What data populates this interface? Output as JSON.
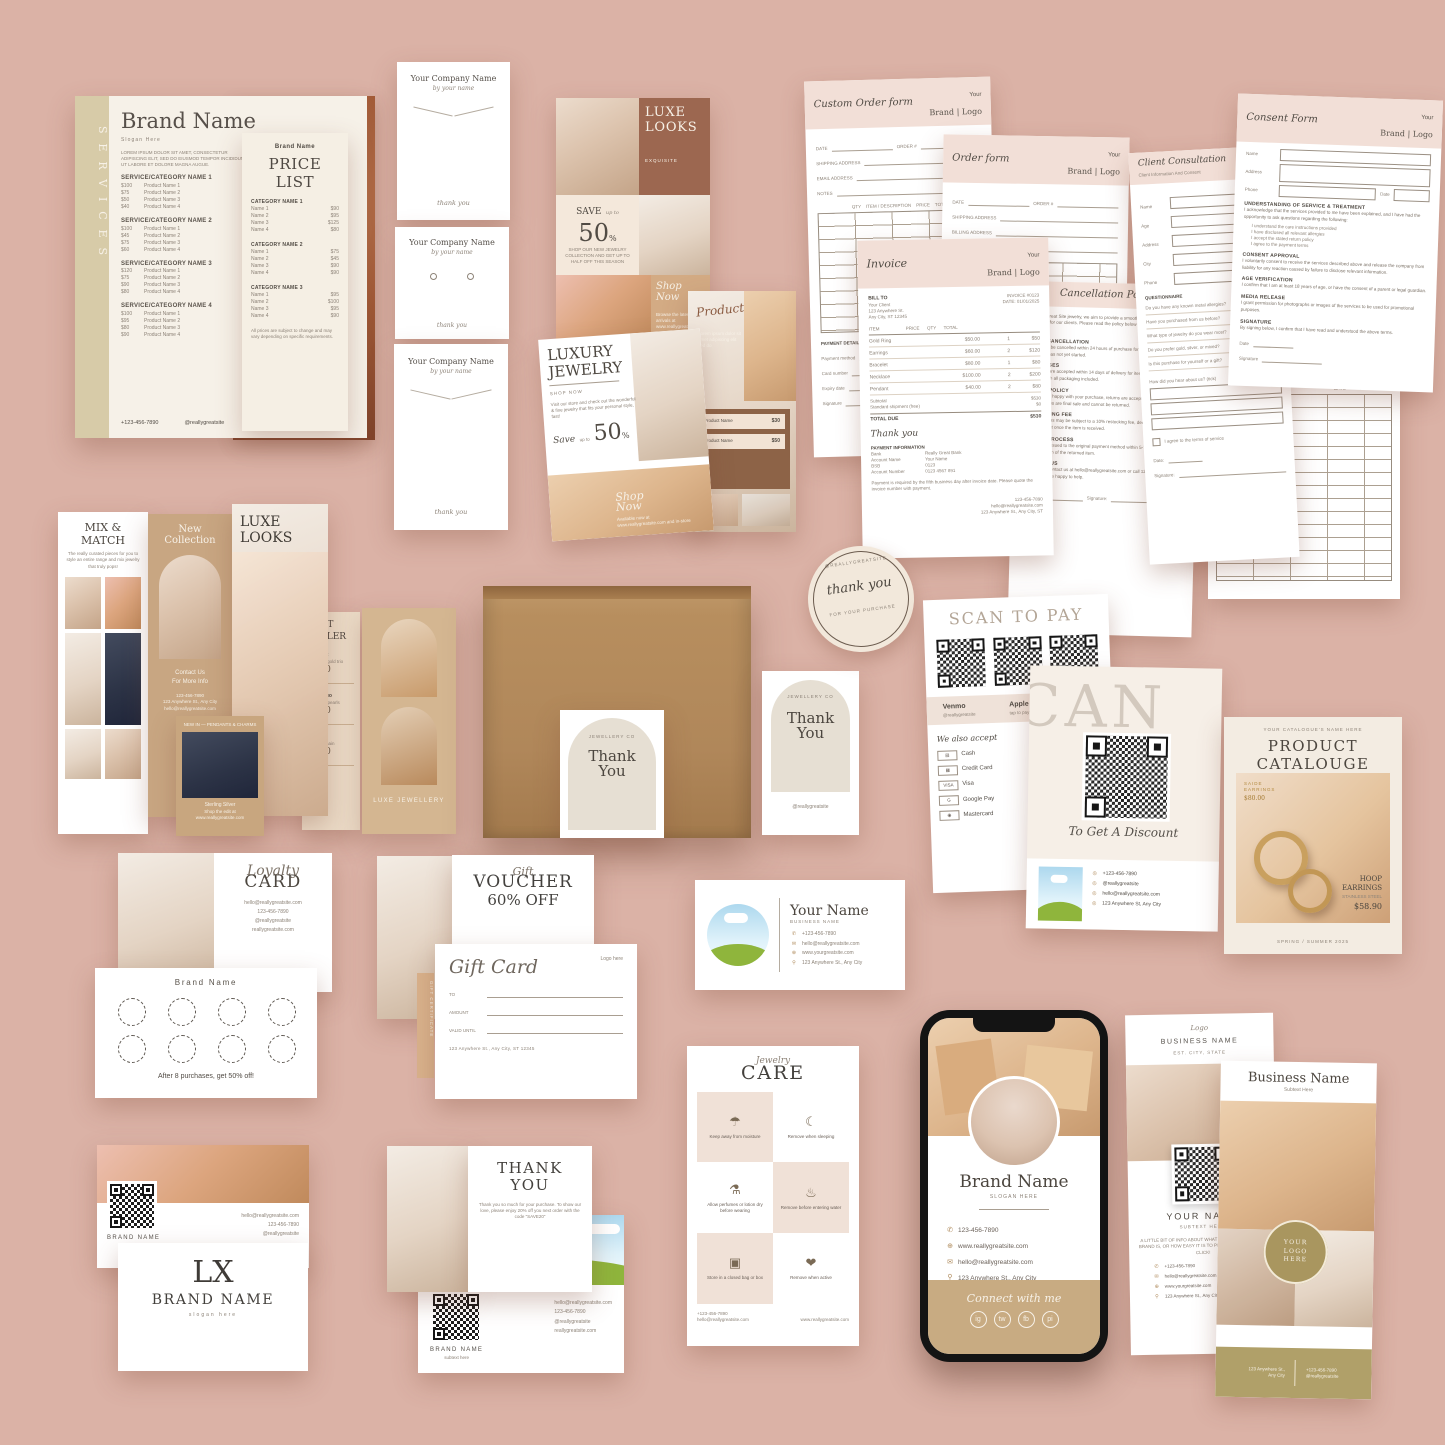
{
  "services": {
    "side_label": "SERVICES",
    "brand": "Brand Name",
    "slogan": "Slogan Here",
    "intro": "LOREM IPSUM DOLOR SIT AMET, CONSECTETUR ADIPISCING ELIT, SED DO EIUSMOD TEMPOR INCIDIDUNT UT LABORE ET DOLORE MAGNA AUGUE.",
    "categories": [
      {
        "name": "SERVICE/CATEGORY NAME 1",
        "rows": [
          {
            "price": "$100",
            "label": "Product Name 1"
          },
          {
            "price": "$75",
            "label": "Product Name 2"
          },
          {
            "price": "$50",
            "label": "Product Name 3"
          },
          {
            "price": "$40",
            "label": "Product Name 4"
          }
        ]
      },
      {
        "name": "SERVICE/CATEGORY NAME 2",
        "rows": [
          {
            "price": "$100",
            "label": "Product Name 1"
          },
          {
            "price": "$45",
            "label": "Product Name 2"
          },
          {
            "price": "$75",
            "label": "Product Name 3"
          },
          {
            "price": "$60",
            "label": "Product Name 4"
          }
        ]
      },
      {
        "name": "SERVICE/CATEGORY NAME 3",
        "rows": [
          {
            "price": "$120",
            "label": "Product Name 1"
          },
          {
            "price": "$75",
            "label": "Product Name 2"
          },
          {
            "price": "$90",
            "label": "Product Name 3"
          },
          {
            "price": "$80",
            "label": "Product Name 4"
          }
        ]
      },
      {
        "name": "SERVICE/CATEGORY NAME 4",
        "rows": [
          {
            "price": "$100",
            "label": "Product Name 1"
          },
          {
            "price": "$95",
            "label": "Product Name 2"
          },
          {
            "price": "$80",
            "label": "Product Name 3"
          },
          {
            "price": "$90",
            "label": "Product Name 4"
          }
        ]
      }
    ],
    "phone": "+123-456-7890",
    "handle": "@reallygreatsite"
  },
  "price_list": {
    "brand": "Brand Name",
    "title": "PRICE LIST",
    "categories": [
      {
        "name": "CATEGORY NAME 1",
        "rows": [
          {
            "label": "Name 1",
            "price": "$90"
          },
          {
            "label": "Name 2",
            "price": "$95"
          },
          {
            "label": "Name 3",
            "price": "$125"
          },
          {
            "label": "Name 4",
            "price": "$80"
          }
        ]
      },
      {
        "name": "CATEGORY NAME 2",
        "rows": [
          {
            "label": "Name 1",
            "price": "$75"
          },
          {
            "label": "Name 2",
            "price": "$45"
          },
          {
            "label": "Name 3",
            "price": "$90"
          },
          {
            "label": "Name 4",
            "price": "$90"
          }
        ]
      },
      {
        "name": "CATEGORY NAME 3",
        "rows": [
          {
            "label": "Name 1",
            "price": "$95"
          },
          {
            "label": "Name 2",
            "price": "$100"
          },
          {
            "label": "Name 3",
            "price": "$95"
          },
          {
            "label": "Name 4",
            "price": "$90"
          }
        ]
      }
    ],
    "footnote": "All prices are subject to change and may vary depending on specific requirements."
  },
  "display_cards": {
    "company": "Your Company Name",
    "byline": "by your name",
    "thanks": "thank you"
  },
  "luxe_grid": {
    "title_1": "LUXE",
    "title_2": "LOOKS",
    "subtitle": "EXQUISITE",
    "save": "SAVE",
    "upto": "up to",
    "pct": "50",
    "pct_sign": "%",
    "save_note": "SHOP OUR NEW JEWELRY COLLECTION AND GET UP TO HALF OFF THIS SEASON",
    "shop_1": "Shop",
    "shop_2": "Now",
    "shop_note": "Browse the latest arrivals at www.reallygreatsite.com"
  },
  "product_collage": {
    "title": "Product Name",
    "note": "Lorem ipsum dolor sit amet adipiscing elit sed do",
    "items": [
      {
        "label": "Product Name",
        "price": "$30"
      },
      {
        "label": "Product Name",
        "price": "$50"
      }
    ]
  },
  "luxury_jewelry": {
    "title_1": "LUXURY",
    "title_2": "JEWELRY",
    "subtitle": "SHOP NOW",
    "body": "Visit our store and check out the wonderful & fine jewelry that fits your personal style, fast!",
    "save": "Save",
    "upto": "up to",
    "pct": "50",
    "pct_sign": "%",
    "shop_1": "Shop",
    "shop_2": "Now",
    "shop_note": "Available now at www.reallygreatsite.com and in-store"
  },
  "custom_order_form": {
    "title": "Custom Order form",
    "brand_top": "Your",
    "brand_bottom": "Brand | Logo",
    "field_date": "DATE",
    "field_order": "ORDER #",
    "field_shipping": "SHIPPING ADDRESS",
    "field_email": "EMAIL ADDRESS",
    "field_notes": "NOTES",
    "cols": "QTY    ITEM / DESCRIPTION    PRICE    TOTAL",
    "payment": "PAYMENT DETAILS",
    "pay_rows": [
      "Payment method",
      "Card number",
      "Expiry date",
      "Signature"
    ]
  },
  "order_form": {
    "title": "Order form",
    "brand_top": "Your",
    "brand_bottom": "Brand | Logo",
    "field_date": "DATE",
    "field_order": "ORDER #",
    "fields": [
      "SHIPPING ADDRESS",
      "BILLING ADDRESS",
      "EMAIL ADDRESS"
    ]
  },
  "invoice": {
    "title": "Invoice",
    "brand_top": "Your",
    "brand_bottom": "Brand | Logo",
    "bill_to": "BILL TO",
    "bill_lines": [
      "Your Client",
      "123 Anywhere St.",
      "Any City, ST 12345"
    ],
    "meta": [
      "INVOICE #0123",
      "DATE: 01/01/2025"
    ],
    "cols": "ITEM                     PRICE      QTY      TOTAL",
    "rows": [
      {
        "item": "Gold Ring",
        "price": "$50.00",
        "qty": "1",
        "total": "$50"
      },
      {
        "item": "Earrings",
        "price": "$60.00",
        "qty": "2",
        "total": "$120"
      },
      {
        "item": "Bracelet",
        "price": "$80.00",
        "qty": "1",
        "total": "$80"
      },
      {
        "item": "Necklace",
        "price": "$100.00",
        "qty": "2",
        "total": "$200"
      },
      {
        "item": "Pendant",
        "price": "$40.00",
        "qty": "2",
        "total": "$80"
      }
    ],
    "subtotal_label": "Subtotal",
    "subtotal": "$530",
    "shipping_label": "Standard shipment (free)",
    "shipping": "$0",
    "total_label": "TOTAL DUE",
    "total": "$530",
    "thanks": "Thank you",
    "payment": "PAYMENT INFORMATION",
    "pay_rows": [
      {
        "k": "Bank",
        "v": "Really Great Bank"
      },
      {
        "k": "Account Name",
        "v": "Your Name"
      },
      {
        "k": "BSB",
        "v": "0123"
      },
      {
        "k": "Account Number",
        "v": "0123 4567 891"
      }
    ],
    "note": "Payment is required by the fifth business day after invoice date. Please quote the invoice number with payment.",
    "footer": [
      "123-456-7890",
      "hello@reallygreatsite.com",
      "123 Anywhere St., Any City, ST"
    ]
  },
  "policy": {
    "title": "Cancellation Policy",
    "intro": "At Really Great Site jewelry, we aim to provide a smooth and enjoyable experience for our clients. Please read the policy below before placing your order.",
    "sections": [
      {
        "h": "ORDER CANCELLATION",
        "b": "Orders may be cancelled within 24 hours of purchase for a full refund, as long as production has not yet started."
      },
      {
        "h": "EXCHANGES",
        "b": "Exchanges are accepted within 14 days of delivery for items in original, unworn condition with all packaging included."
      },
      {
        "h": "RETURN POLICY",
        "b": "If you are not happy with your purchase, returns are accepted within 14 days. Custom pieces are final sale and cannot be returned."
      },
      {
        "h": "RESTOCKING FEE",
        "b": "Returned items may be subject to a 10% restocking fee, deducted from the refund amount once the item is received."
      },
      {
        "h": "REFUND PROCESS",
        "b": "Refunds are issued to the original payment method within 5-7 business days after inspection of the returned item."
      },
      {
        "h": "CONTACT US",
        "b": "Questions? Contact us at hello@reallygreatsite.com or call 123-456-7890 and our team will be happy to help."
      }
    ],
    "date_label": "Date:",
    "sign_label": "Signature:"
  },
  "client_consult": {
    "title": "Client Consultation",
    "subtitle": "Client Information And Consent",
    "fields": [
      "Name",
      "Age",
      "Address",
      "City",
      "Phone"
    ],
    "heading": "QUESTIONNAIRE",
    "items": [
      "Do you have any known metal allergies?",
      "Have you purchased from us before?",
      "What type of jewelry do you wear most?",
      "Do you prefer gold, silver, or mixed?",
      "Is this purchase for yourself or a gift?"
    ],
    "extra": "How did you hear about us? (tick)",
    "check": "I agree to the terms of service",
    "date_label": "Date:",
    "sign_label": "Signature:"
  },
  "consent_form": {
    "title": "Consent Form",
    "brand_top": "Your",
    "brand_bottom": "Brand | Logo",
    "f_name": "Name",
    "f_address": "Address",
    "f_phone": "Phone",
    "f_date": "Date",
    "sections": [
      {
        "h": "UNDERSTANDING OF SERVICE & TREATMENT",
        "b": "I acknowledge that the services provided to me have been explained, and I have had the opportunity to ask questions regarding the following:"
      },
      {
        "h": "CONSENT APPROVAL",
        "b": "I voluntarily consent to receive the services described above and release the company from liability for any reaction caused by failure to disclose relevant information."
      },
      {
        "h": "AGE VERIFICATION",
        "b": "I confirm that I am at least 18 years of age, or have the consent of a parent or legal guardian."
      },
      {
        "h": "MEDIA RELEASE",
        "b": "I grant permission for photographs or images of the services to be used for promotional purposes."
      },
      {
        "h": "SIGNATURE",
        "b": "By signing below, I confirm that I have read and understood the above terms."
      }
    ],
    "bullets": [
      "I understand the care instructions provided",
      "I have disclosed all relevant allergies",
      "I accept the stated return policy",
      "I agree to the payment terms"
    ],
    "date_label": "Date",
    "sign_label": "Signature"
  },
  "ledger": {
    "logo": "Brand | Logo",
    "col_1": "DATE",
    "col_2": "AMOUNT DUE"
  },
  "mix_match": {
    "title_1": "MIX &",
    "title_2": "MATCH",
    "body": "The really curated pieces for you to style an entire range and mix jewelry that truly pops!"
  },
  "new_collection": {
    "title_1": "New",
    "title_2": "Collection",
    "cta_1": "Contact Us",
    "cta_2": "For More Info",
    "lines": [
      "123-456-7890",
      "123 Anywhere St., Any City",
      "hello@reallygreatsite.com"
    ]
  },
  "luxe_story": {
    "title_1": "LUXE",
    "title_2": "LOOKS"
  },
  "best_seller": {
    "title": "BEST SELLER",
    "items": [
      {
        "label": "Ring Set",
        "note": "Timeless gold trio",
        "price": "$300"
      },
      {
        "label": "Hoop Duo",
        "note": "Hand-set pearls",
        "price": "$200"
      },
      {
        "label": "Pendant",
        "note": "Classic chain",
        "price": "$100"
      }
    ]
  },
  "display_stand": {
    "caption": "LUXE JEWELLERY"
  },
  "pendant_collage": {
    "top": "NEW IN — PENDANTS & CHARMS",
    "caption": "Sterling Silver",
    "note": "Shop the edit at www.reallygreatsite.com"
  },
  "box_tag": {
    "brand": "JEWELLERY CO",
    "title_1": "Thank",
    "title_2": "You",
    "handle": "@reallygreatsite"
  },
  "sticker": {
    "top": "@REALLYGREATSITE",
    "script": "thank you",
    "bottom": "FOR YOUR PURCHASE"
  },
  "scan_pay": {
    "title": "SCAN TO PAY",
    "methods_row": [
      {
        "name": "Venmo",
        "sub": "@reallygreatsite"
      },
      {
        "name": "Apple Pay",
        "sub": "tap to pay"
      }
    ],
    "accept": "We also accept",
    "accept_list": [
      {
        "icon": "▤",
        "label": "Cash"
      },
      {
        "icon": "▦",
        "label": "Credit Card"
      },
      {
        "icon": "VISA",
        "label": "Visa"
      },
      {
        "icon": "G",
        "label": "Google Pay"
      },
      {
        "icon": "◉",
        "label": "Mastercard"
      }
    ]
  },
  "scan_discount": {
    "ghost": "SCAN",
    "script": "To Get A Discount",
    "contacts": [
      "+123-456-7890",
      "@reallygreatsite",
      "hello@reallygreatsite.com",
      "123 Anywhere St, Any City"
    ]
  },
  "catalogue": {
    "header": "YOUR CATALOGUE'S NAME HERE",
    "title": "PRODUCT",
    "title_2": "CATALOUGE",
    "tag_a_1": "SAIDE",
    "tag_a_2": "EARRINGS",
    "tag_a_price": "$80.00",
    "tag_b_1": "HOOP",
    "tag_b_2": "EARRINGS",
    "tag_b_sub": "STAINLESS STEEL",
    "tag_b_price": "$58.90",
    "footer": "SPRING / SUMMER 2025"
  },
  "loyalty": {
    "script": "Loyalty",
    "title": "CARD",
    "contacts": [
      "hello@reallygreatsite.com",
      "123-456-7890",
      "@reallygreatsite",
      "reallygreatsite.com"
    ],
    "back_brand": "Brand Name",
    "back_note": "After 8 purchases, get 50% off!"
  },
  "gift": {
    "voucher_script": "Gift",
    "voucher_title": "VOUCHER",
    "voucher_off": "60% OFF",
    "strip": "GIFT CERTIFICATE",
    "card_script": "Gift Card",
    "logo": "Logo here",
    "field_1": "TO",
    "field_2": "AMOUNT",
    "field_3": "VALID UNTIL",
    "address": "123 Anywhere St., Any City, ST 12345"
  },
  "business_card": {
    "name": "Your Name",
    "subtitle": "BUSINESS NAME",
    "contacts": [
      {
        "icon": "✆",
        "text": "+123-456-7890"
      },
      {
        "icon": "✉",
        "text": "hello@reallygreatsite.com"
      },
      {
        "icon": "⊕",
        "text": "www.yourgreatsite.com"
      },
      {
        "icon": "⚲",
        "text": "123 Anywhere St., Any City"
      }
    ]
  },
  "care": {
    "script": "Jewelry",
    "title": "CARE",
    "tiles": [
      {
        "icon": "☂",
        "label": "Keep away from moisture"
      },
      {
        "icon": "☾",
        "label": "Remove when sleeping"
      },
      {
        "icon": "⚗",
        "label": "Allow perfumes or lotion dry before wearing"
      },
      {
        "icon": "♨",
        "label": "Remove before entering water"
      },
      {
        "icon": "▣",
        "label": "Store in a closed bag or box"
      },
      {
        "icon": "❤",
        "label": "Remove when active"
      }
    ],
    "foot_phone": "+123-456-7890",
    "foot_email": "hello@reallygreatsite.com",
    "foot_site": "www.reallygreatsite.com"
  },
  "phone_mock": {
    "brand": "Brand Name",
    "slogan": "SLOGAN HERE",
    "contacts": [
      {
        "icon": "✆",
        "text": "123-456-7890"
      },
      {
        "icon": "⊕",
        "text": "www.reallygreatsite.com"
      },
      {
        "icon": "✉",
        "text": "hello@reallygreatsite.com"
      },
      {
        "icon": "⚲",
        "text": "123 Anywhere St., Any City"
      }
    ],
    "connect": "Connect with me",
    "social": [
      "ig",
      "tw",
      "fb",
      "pi"
    ]
  },
  "rack_back": {
    "logo": "Logo",
    "business": "BUSINESS NAME",
    "sub": "EST. CITY, STATE",
    "name": "YOUR NAME",
    "name_sub": "SUBTEXT HERE",
    "body": "A LITTLE BIT OF INFO ABOUT WHAT YOU DO, WHAT YOUR BRAND IS, OR HOW EASY IT IS TO PLACE AN ORDER. JUST CLICK!",
    "contacts": [
      {
        "icon": "✆",
        "text": "+123-456-7890"
      },
      {
        "icon": "✉",
        "text": "hello@reallygreatsite.com"
      },
      {
        "icon": "⊕",
        "text": "www.yourgreatsite.com"
      },
      {
        "icon": "⚲",
        "text": "123 Anywhere St., Any City"
      }
    ]
  },
  "rack_front": {
    "business": "Business Name",
    "sub": "Subtext Here",
    "logo_1": "YOUR",
    "logo_2": "LOGO",
    "logo_3": "HERE",
    "foot_addr_1": "123 Anywhere St.,",
    "foot_addr_2": "Any City",
    "foot_contact_1": "+123-456-7890",
    "foot_contact_2": "@reallygreatsite"
  },
  "lx_cards": {
    "back_brand": "BRAND NAME",
    "back_contacts": [
      "hello@reallygreatsite.com",
      "123-456-7890",
      "@reallygreatsite"
    ],
    "monogram": "LX",
    "brand": "BRAND NAME",
    "slogan": "slogan here"
  },
  "thanks_card": {
    "title_1": "THANK",
    "title_2": "YOU",
    "body": "Thank you so much for your purchase. To show our love, please enjoy 20% off you next order with the code “SAVE20”",
    "back_brand": "BRAND NAME",
    "back_sub": "subtext here",
    "back_contacts": [
      "hello@reallygreatsite.com",
      "123-456-7890",
      "@reallygreatsite",
      "reallygreatsite.com"
    ]
  }
}
